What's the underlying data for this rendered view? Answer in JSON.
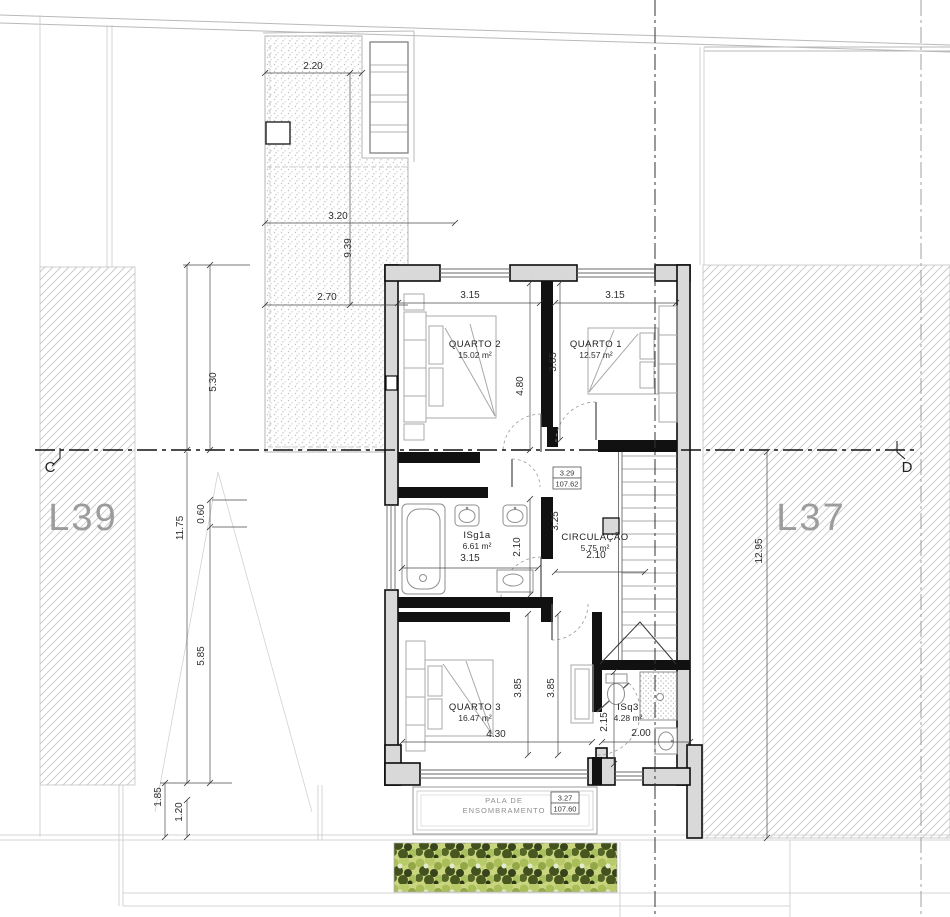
{
  "drawing": {
    "lots": [
      {
        "label": "L39",
        "x": 83,
        "y": 530
      },
      {
        "label": "L37",
        "x": 811,
        "y": 530
      }
    ],
    "section_markers": [
      {
        "label": "C",
        "x": 50,
        "y": 472
      },
      {
        "label": "D",
        "x": 907,
        "y": 472
      }
    ],
    "rooms": [
      {
        "name": "QUARTO 2",
        "area": "15.02 m²",
        "x": 475,
        "y": 347
      },
      {
        "name": "QUARTO 1",
        "area": "12.57 m²",
        "x": 596,
        "y": 347
      },
      {
        "name": "ISg1a",
        "area": "6.61 m²",
        "x": 477,
        "y": 538
      },
      {
        "name": "CIRCULAÇÃO",
        "area": "5.75 m²",
        "x": 595,
        "y": 540
      },
      {
        "name": "QUARTO 3",
        "area": "16.47 m²",
        "x": 475,
        "y": 710
      },
      {
        "name": "ISq3",
        "area": "4.28 m²",
        "x": 628,
        "y": 710
      }
    ],
    "levels": [
      {
        "level": "3.29",
        "elevation": "107.62"
      },
      {
        "level": "3.27",
        "elevation": "107.60"
      }
    ],
    "annotations": [
      {
        "text": "PALA DE",
        "x": 504,
        "y": 803
      },
      {
        "text": "ENSOMBRAMENTO",
        "x": 504,
        "y": 813
      }
    ],
    "dimensions": [
      {
        "v": "2.20",
        "x": 313,
        "y": 69,
        "rot": 0
      },
      {
        "v": "3.20",
        "x": 338,
        "y": 219,
        "rot": 0
      },
      {
        "v": "2.70",
        "x": 327,
        "y": 300,
        "rot": 0
      },
      {
        "v": "9.39",
        "x": 351,
        "y": 248,
        "rot": -90
      },
      {
        "v": "5.30",
        "x": 216,
        "y": 382,
        "rot": -90
      },
      {
        "v": "0.60",
        "x": 204,
        "y": 514,
        "rot": -90
      },
      {
        "v": "11.75",
        "x": 183,
        "y": 528,
        "rot": -90
      },
      {
        "v": "5.85",
        "x": 204,
        "y": 656,
        "rot": -90
      },
      {
        "v": "1.85",
        "x": 161,
        "y": 797,
        "rot": -90
      },
      {
        "v": "1.20",
        "x": 182,
        "y": 812,
        "rot": -90
      },
      {
        "v": "12.95",
        "x": 762,
        "y": 551,
        "rot": -90
      },
      {
        "v": "3.15",
        "x": 470,
        "y": 298,
        "rot": 0
      },
      {
        "v": "3.15",
        "x": 615,
        "y": 298,
        "rot": 0
      },
      {
        "v": "4.80",
        "x": 523,
        "y": 386,
        "rot": -90
      },
      {
        "v": "3.65",
        "x": 556,
        "y": 362,
        "rot": -90
      },
      {
        "v": "3.15",
        "x": 470,
        "y": 561,
        "rot": 0
      },
      {
        "v": "2.10",
        "x": 520,
        "y": 547,
        "rot": -90
      },
      {
        "v": "3.25",
        "x": 558,
        "y": 521,
        "rot": -90
      },
      {
        "v": "2.10",
        "x": 596,
        "y": 558,
        "rot": 0
      },
      {
        "v": "3.85",
        "x": 521,
        "y": 688,
        "rot": -90
      },
      {
        "v": "3.85",
        "x": 554,
        "y": 688,
        "rot": -90
      },
      {
        "v": "4.30",
        "x": 496,
        "y": 737,
        "rot": 0
      },
      {
        "v": "2.15",
        "x": 607,
        "y": 722,
        "rot": -90
      },
      {
        "v": "2.00",
        "x": 641,
        "y": 736,
        "rot": 0
      }
    ]
  }
}
